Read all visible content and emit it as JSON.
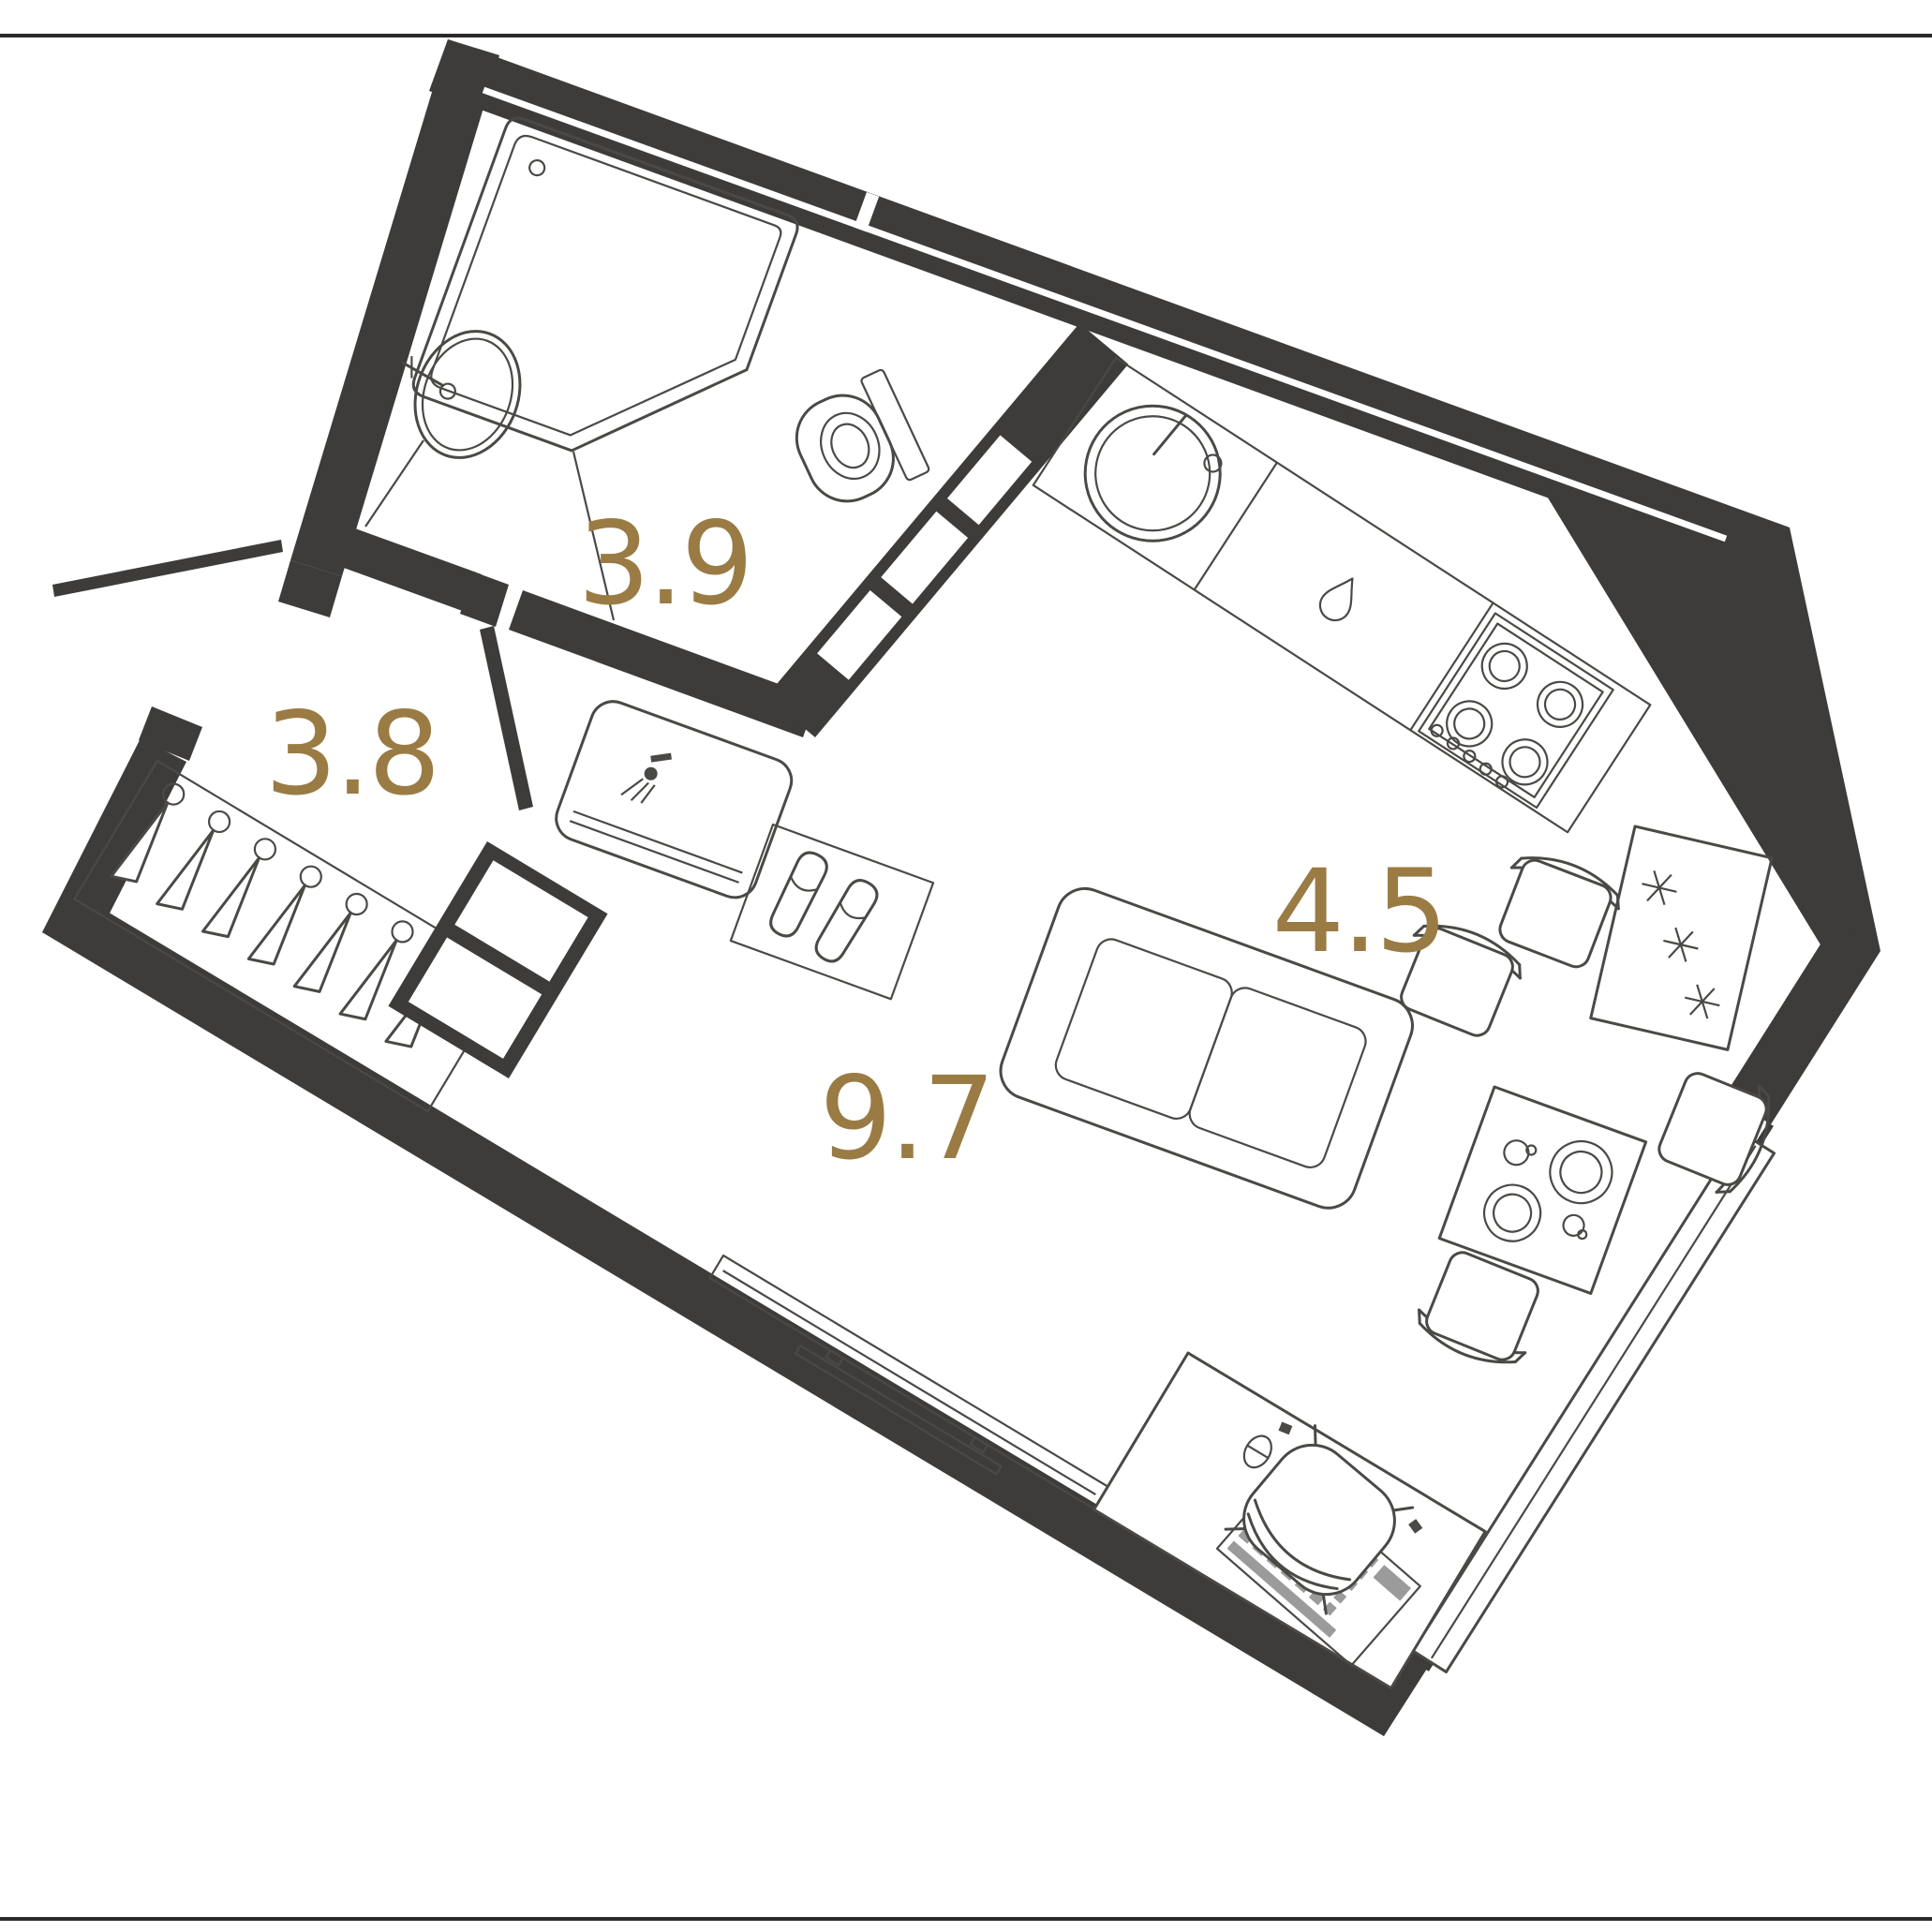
{
  "page": {
    "type": "apartment-floor-plan",
    "units": "m2"
  },
  "rooms": [
    {
      "id": "bathroom",
      "area_label": "3.9"
    },
    {
      "id": "hallway",
      "area_label": "3.8"
    },
    {
      "id": "kitchen",
      "area_label": "4.5"
    },
    {
      "id": "living-room",
      "area_label": "9.7"
    }
  ],
  "colors": {
    "wall": "#3d3c3b",
    "line": "#4b4946",
    "accent": "#9a7b44",
    "background": "#ffffff",
    "keys": "#9b9b9b"
  },
  "fixtures": [
    "shower-cabin",
    "washbasin",
    "toilet",
    "vanity-sink",
    "slippers-mat",
    "shelf-niche-wall",
    "entry-door-leaf",
    "bathroom-door-leaf",
    "coat-hanger-rail",
    "closet-shelves",
    "kitchen-sink",
    "dishwasher-drop-icon",
    "stove-4-burners",
    "fridge-snowflakes",
    "sofa",
    "dining-table",
    "dining-chair",
    "desk",
    "keyboard",
    "mouse",
    "desk-chair",
    "tv-console",
    "window-strip"
  ]
}
